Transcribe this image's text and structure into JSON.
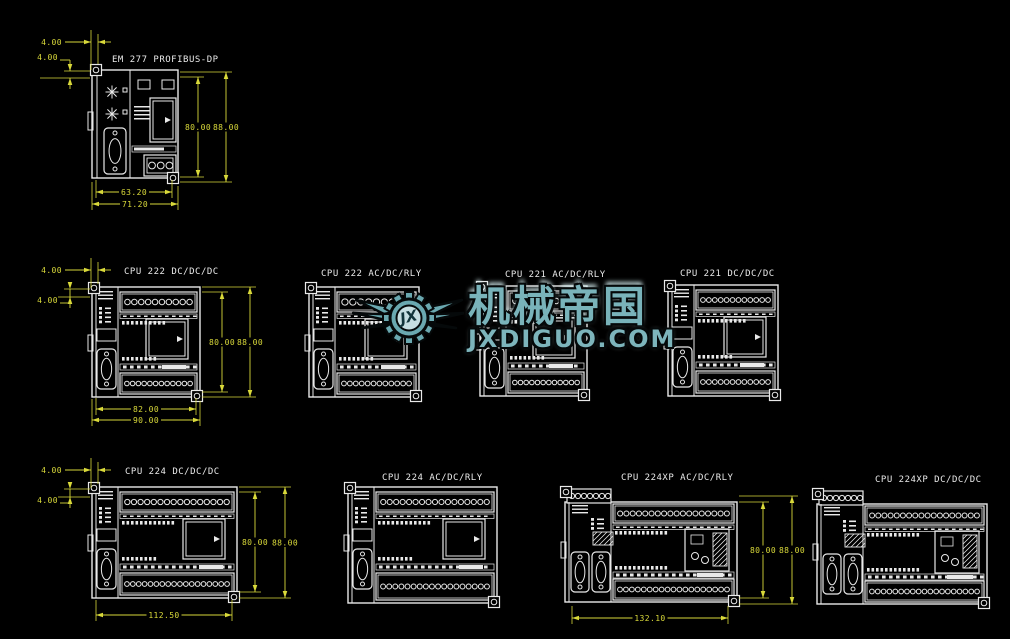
{
  "canvas": {
    "width": 1010,
    "height": 639,
    "background": "#000000",
    "line_color": "#e9e9e9",
    "dim_color": "#d9d93a",
    "label_color": "#e9e9e9"
  },
  "watermark": {
    "logo_monogram": "JX",
    "title": "机械帝国",
    "site": "JXDIGUO.COM",
    "fill": "#6aa8b0",
    "light": "#c6dee1",
    "outline": "#05090a",
    "x": 352,
    "y": 280
  },
  "modules": [
    {
      "id": "em277",
      "label": "EM 277 PROFIBUS-DP",
      "kind": "em277",
      "body": {
        "x": 92,
        "y": 70,
        "w": 86,
        "h": 108
      },
      "terminal_circles": 3,
      "label_pos": {
        "x": 112,
        "y": 62
      }
    },
    {
      "id": "cpu222dc",
      "label": "CPU 222 DC/DC/DC",
      "kind": "cpu",
      "body": {
        "x": 92,
        "y": 287,
        "w": 108,
        "h": 110
      },
      "top_circles": 10,
      "bottom_circles": 12,
      "label_pos": {
        "x": 124,
        "y": 274
      }
    },
    {
      "id": "cpu222ac",
      "label": "CPU 222 AC/DC/RLY",
      "kind": "cpu",
      "body": {
        "x": 309,
        "y": 287,
        "w": 110,
        "h": 110
      },
      "top_circles": 9,
      "bottom_circles": 12,
      "label_pos": {
        "x": 321,
        "y": 276
      }
    },
    {
      "id": "cpu221ac",
      "label": "CPU 221 AC/DC/RLY",
      "kind": "cpu",
      "body": {
        "x": 480,
        "y": 286,
        "w": 107,
        "h": 110
      },
      "top_circles": 10,
      "bottom_circles": 12,
      "label_pos": {
        "x": 505,
        "y": 277
      }
    },
    {
      "id": "cpu221dc",
      "label": "CPU 221 DC/DC/DC",
      "kind": "cpu",
      "body": {
        "x": 668,
        "y": 285,
        "w": 110,
        "h": 111
      },
      "top_circles": 12,
      "bottom_circles": 12,
      "label_pos": {
        "x": 680,
        "y": 276
      }
    },
    {
      "id": "cpu224dc",
      "label": "CPU 224 DC/DC/DC",
      "kind": "cpu",
      "body": {
        "x": 92,
        "y": 487,
        "w": 145,
        "h": 111
      },
      "top_circles": 16,
      "bottom_circles": 18,
      "label_pos": {
        "x": 125,
        "y": 474
      }
    },
    {
      "id": "cpu224ac",
      "label": "CPU 224 AC/DC/RLY",
      "kind": "cpu",
      "body": {
        "x": 348,
        "y": 487,
        "w": 149,
        "h": 116
      },
      "top_circles": 17,
      "bottom_circles": 18,
      "label_pos": {
        "x": 382,
        "y": 480
      }
    },
    {
      "id": "cpu224xpac",
      "label": "CPU 224XP AC/DC/RLY",
      "kind": "cpuxp",
      "body": {
        "x": 565,
        "y": 489,
        "w": 172,
        "h": 113
      },
      "top_circles": 18,
      "bottom_circles": 19,
      "label_pos": {
        "x": 621,
        "y": 480
      }
    },
    {
      "id": "cpu224xpdc",
      "label": "CPU 224XP DC/DC/DC",
      "kind": "cpuxp",
      "body": {
        "x": 817,
        "y": 491,
        "w": 170,
        "h": 113
      },
      "top_circles": 18,
      "bottom_circles": 19,
      "label_pos": {
        "x": 875,
        "y": 482
      }
    }
  ],
  "dimensions": [
    {
      "module": "em277",
      "value": "4.00",
      "type": "h",
      "y": 42,
      "x1": 91,
      "x2": 98,
      "label_x": 62,
      "label_y": 45,
      "outside": true,
      "ext": [
        [
          91,
          30,
          70
        ],
        [
          98,
          34,
          64
        ]
      ]
    },
    {
      "module": "em277",
      "value": "4.00",
      "type": "v",
      "x": 70,
      "y1": 71,
      "y2": 78,
      "label_x": 58,
      "label_y": 60,
      "outside": true,
      "ext": [
        [
          71,
          90,
          64
        ],
        [
          78,
          90,
          40
        ]
      ]
    },
    {
      "module": "em277",
      "value": "80.00",
      "type": "v",
      "x": 198,
      "y1": 77,
      "y2": 177,
      "ext": [
        [
          77,
          180,
          204
        ],
        [
          177,
          180,
          204
        ]
      ]
    },
    {
      "module": "em277",
      "value": "88.00",
      "type": "v",
      "x": 226,
      "y1": 72,
      "y2": 182,
      "ext": [
        [
          72,
          180,
          232
        ],
        [
          182,
          180,
          232
        ]
      ]
    },
    {
      "module": "em277",
      "value": "63.20",
      "type": "h",
      "y": 192,
      "x1": 96,
      "x2": 172,
      "ext": [
        [
          96,
          180,
          198
        ],
        [
          172,
          180,
          198
        ]
      ]
    },
    {
      "module": "em277",
      "value": "71.20",
      "type": "h",
      "y": 204,
      "x1": 92,
      "x2": 178,
      "ext": [
        [
          92,
          182,
          210
        ],
        [
          178,
          186,
          210
        ]
      ]
    },
    {
      "module": "cpu222dc",
      "value": "4.00",
      "type": "h",
      "y": 270,
      "x1": 91,
      "x2": 98,
      "label_x": 62,
      "label_y": 273,
      "outside": true,
      "ext": [
        [
          91,
          258,
          288
        ],
        [
          98,
          262,
          284
        ]
      ]
    },
    {
      "module": "cpu222dc",
      "value": "4.00",
      "type": "v",
      "x": 70,
      "y1": 289,
      "y2": 297,
      "label_x": 58,
      "label_y": 303,
      "outside": true,
      "ext": [
        [
          289,
          90,
          64
        ],
        [
          297,
          90,
          42
        ]
      ]
    },
    {
      "module": "cpu222dc",
      "value": "80.00",
      "type": "v",
      "x": 222,
      "y1": 292,
      "y2": 392,
      "ext": [
        [
          292,
          202,
          228
        ],
        [
          392,
          202,
          228
        ]
      ]
    },
    {
      "module": "cpu222dc",
      "value": "88.00",
      "type": "v",
      "x": 250,
      "y1": 287,
      "y2": 397,
      "ext": [
        [
          287,
          202,
          256
        ],
        [
          397,
          202,
          256
        ]
      ]
    },
    {
      "module": "cpu222dc",
      "value": "82.00",
      "type": "h",
      "y": 409,
      "x1": 96,
      "x2": 196,
      "ext": [
        [
          96,
          398,
          415
        ],
        [
          196,
          398,
          415
        ]
      ]
    },
    {
      "module": "cpu222dc",
      "value": "90.00",
      "type": "h",
      "y": 420,
      "x1": 92,
      "x2": 200,
      "ext": [
        [
          92,
          399,
          426
        ],
        [
          200,
          401,
          426
        ]
      ]
    },
    {
      "module": "cpu224dc",
      "value": "4.00",
      "type": "h",
      "y": 470,
      "x1": 91,
      "x2": 98,
      "label_x": 62,
      "label_y": 473,
      "outside": true,
      "ext": [
        [
          91,
          458,
          488
        ],
        [
          98,
          462,
          484
        ]
      ]
    },
    {
      "module": "cpu224dc",
      "value": "4.00",
      "type": "v",
      "x": 70,
      "y1": 489,
      "y2": 497,
      "label_x": 58,
      "label_y": 503,
      "outside": true,
      "ext": [
        [
          489,
          90,
          64
        ],
        [
          497,
          90,
          42
        ]
      ]
    },
    {
      "module": "cpu224dc",
      "value": "80.00",
      "type": "v",
      "x": 255,
      "y1": 492,
      "y2": 592,
      "ext": [
        [
          492,
          239,
          261
        ],
        [
          592,
          239,
          261
        ]
      ]
    },
    {
      "module": "cpu224dc",
      "value": "88.00",
      "type": "v",
      "x": 285,
      "y1": 487,
      "y2": 598,
      "ext": [
        [
          487,
          239,
          291
        ],
        [
          598,
          239,
          291
        ]
      ]
    },
    {
      "module": "cpu224dc",
      "value": "112.50",
      "type": "h",
      "y": 615,
      "x1": 96,
      "x2": 232,
      "ext": [
        [
          96,
          600,
          621
        ],
        [
          232,
          600,
          621
        ]
      ]
    },
    {
      "module": "cpu224xpac",
      "value": "80.00",
      "type": "v",
      "x": 763,
      "y1": 502,
      "y2": 598,
      "ext": [
        [
          502,
          739,
          769
        ],
        [
          598,
          739,
          769
        ]
      ]
    },
    {
      "module": "cpu224xpac",
      "value": "88.00",
      "type": "v",
      "x": 792,
      "y1": 496,
      "y2": 604,
      "ext": [
        [
          496,
          739,
          798
        ],
        [
          604,
          739,
          798
        ]
      ]
    },
    {
      "module": "cpu224xpac",
      "value": "132.10",
      "type": "h",
      "y": 618,
      "x1": 572,
      "x2": 728,
      "ext": [
        [
          572,
          606,
          624
        ],
        [
          728,
          606,
          624
        ]
      ]
    }
  ]
}
